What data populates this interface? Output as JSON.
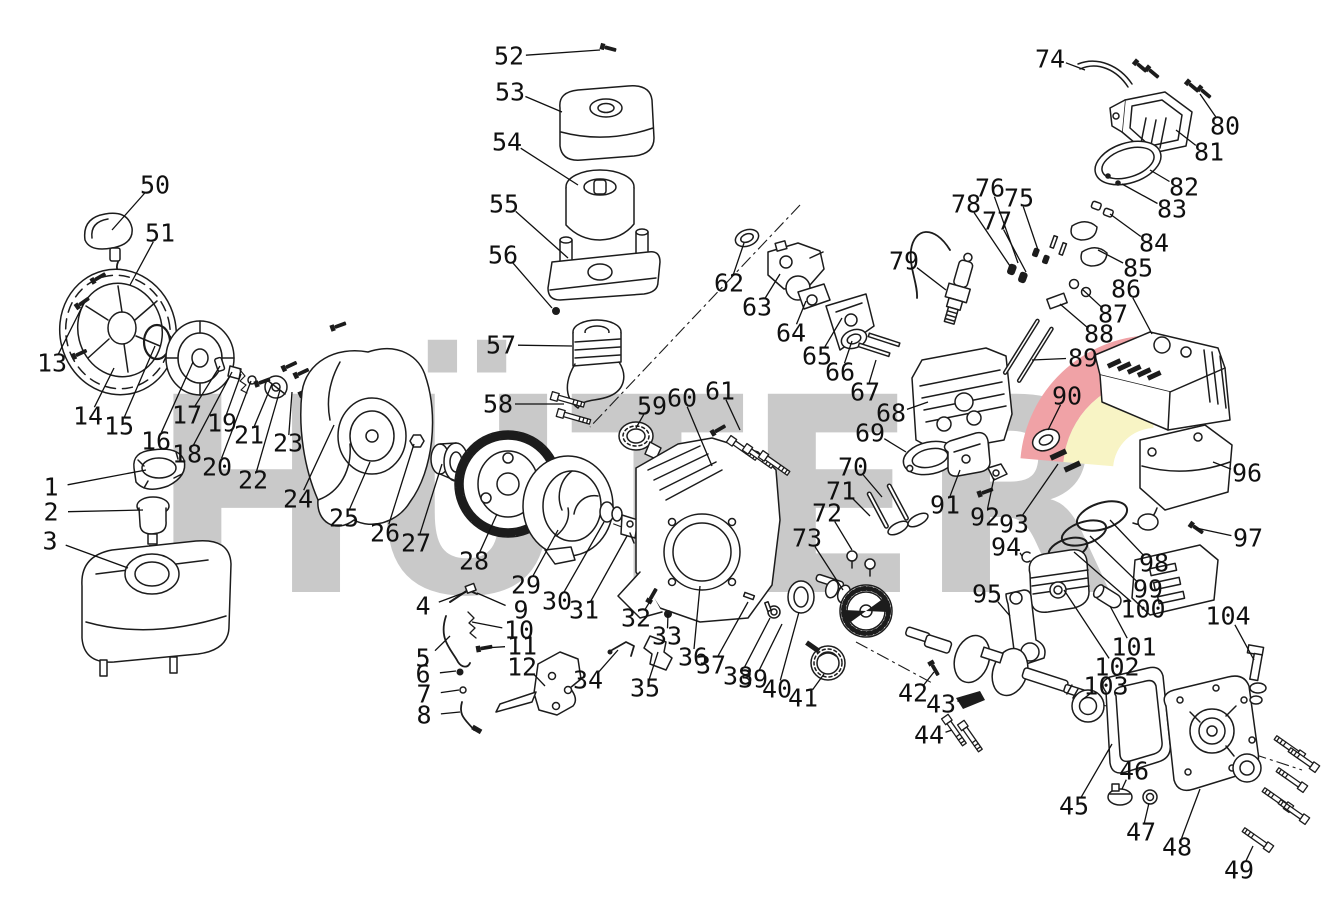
{
  "watermark": {
    "text": "HÜTER",
    "gray": "#c9c9c9",
    "red": "#f0a2a6",
    "yellow": "#f8f4c5"
  },
  "diagram": {
    "stroke_color": "#1c1c1c",
    "parts": [
      {
        "n": "1",
        "lx": 51,
        "ly": 487,
        "tx": 146,
        "ty": 470
      },
      {
        "n": "2",
        "lx": 51,
        "ly": 512,
        "tx": 143,
        "ty": 510
      },
      {
        "n": "3",
        "lx": 50,
        "ly": 541,
        "tx": 128,
        "ty": 568
      },
      {
        "n": "4",
        "lx": 423,
        "ly": 606,
        "tx": 466,
        "ty": 592
      },
      {
        "n": "5",
        "lx": 423,
        "ly": 658,
        "tx": 450,
        "ty": 636
      },
      {
        "n": "6",
        "lx": 423,
        "ly": 674,
        "tx": 456,
        "ty": 671
      },
      {
        "n": "7",
        "lx": 424,
        "ly": 694,
        "tx": 459,
        "ty": 690
      },
      {
        "n": "8",
        "lx": 424,
        "ly": 715,
        "tx": 460,
        "ty": 712
      },
      {
        "n": "9",
        "lx": 521,
        "ly": 610,
        "tx": 477,
        "ty": 593
      },
      {
        "n": "10",
        "lx": 519,
        "ly": 630,
        "tx": 472,
        "ty": 622
      },
      {
        "n": "11",
        "lx": 522,
        "ly": 646,
        "tx": 484,
        "ty": 648
      },
      {
        "n": "12",
        "lx": 522,
        "ly": 667,
        "tx": 545,
        "ty": 686
      },
      {
        "n": "13",
        "lx": 52,
        "ly": 363,
        "tx": 84,
        "ty": 303
      },
      {
        "n": "14",
        "lx": 88,
        "ly": 416,
        "tx": 114,
        "ty": 368
      },
      {
        "n": "15",
        "lx": 119,
        "ly": 426,
        "tx": 155,
        "ty": 346
      },
      {
        "n": "16",
        "lx": 156,
        "ly": 441,
        "tx": 193,
        "ty": 362
      },
      {
        "n": "17",
        "lx": 187,
        "ly": 415,
        "tx": 220,
        "ty": 366
      },
      {
        "n": "18",
        "lx": 187,
        "ly": 454,
        "tx": 232,
        "ty": 372
      },
      {
        "n": "19",
        "lx": 222,
        "ly": 423,
        "tx": 241,
        "ty": 374
      },
      {
        "n": "20",
        "lx": 217,
        "ly": 467,
        "tx": 251,
        "ty": 381
      },
      {
        "n": "21",
        "lx": 249,
        "ly": 435,
        "tx": 272,
        "ty": 384
      },
      {
        "n": "22",
        "lx": 253,
        "ly": 480,
        "tx": 280,
        "ty": 390
      },
      {
        "n": "23",
        "lx": 288,
        "ly": 443,
        "tx": 292,
        "ty": 392
      },
      {
        "n": "24",
        "lx": 298,
        "ly": 499,
        "tx": 334,
        "ty": 425
      },
      {
        "n": "25",
        "lx": 344,
        "ly": 518,
        "tx": 370,
        "ty": 462
      },
      {
        "n": "26",
        "lx": 385,
        "ly": 533,
        "tx": 414,
        "ty": 444
      },
      {
        "n": "27",
        "lx": 416,
        "ly": 543,
        "tx": 442,
        "ty": 464
      },
      {
        "n": "28",
        "lx": 474,
        "ly": 561,
        "tx": 497,
        "ty": 514
      },
      {
        "n": "29",
        "lx": 526,
        "ly": 585,
        "tx": 558,
        "ty": 530
      },
      {
        "n": "30",
        "lx": 557,
        "ly": 601,
        "tx": 604,
        "ty": 522
      },
      {
        "n": "31",
        "lx": 584,
        "ly": 610,
        "tx": 627,
        "ty": 536
      },
      {
        "n": "32",
        "lx": 636,
        "ly": 618,
        "tx": 652,
        "ty": 598
      },
      {
        "n": "33",
        "lx": 667,
        "ly": 636,
        "tx": 668,
        "ty": 614
      },
      {
        "n": "34",
        "lx": 588,
        "ly": 680,
        "tx": 618,
        "ty": 650
      },
      {
        "n": "35",
        "lx": 645,
        "ly": 688,
        "tx": 658,
        "ty": 652
      },
      {
        "n": "36",
        "lx": 693,
        "ly": 657,
        "tx": 700,
        "ty": 586
      },
      {
        "n": "37",
        "lx": 711,
        "ly": 665,
        "tx": 748,
        "ty": 602
      },
      {
        "n": "38",
        "lx": 738,
        "ly": 676,
        "tx": 770,
        "ty": 618
      },
      {
        "n": "39",
        "lx": 753,
        "ly": 679,
        "tx": 782,
        "ty": 624
      },
      {
        "n": "40",
        "lx": 777,
        "ly": 689,
        "tx": 799,
        "ty": 612
      },
      {
        "n": "41",
        "lx": 803,
        "ly": 698,
        "tx": 824,
        "ty": 674
      },
      {
        "n": "42",
        "lx": 913,
        "ly": 693,
        "tx": 934,
        "ty": 672
      },
      {
        "n": "43",
        "lx": 941,
        "ly": 704,
        "tx": 960,
        "ty": 700
      },
      {
        "n": "44",
        "lx": 929,
        "ly": 735,
        "tx": 952,
        "ty": 730
      },
      {
        "n": "45",
        "lx": 1074,
        "ly": 806,
        "tx": 1112,
        "ty": 744
      },
      {
        "n": "46",
        "lx": 1134,
        "ly": 771,
        "tx": 1122,
        "ty": 789
      },
      {
        "n": "47",
        "lx": 1141,
        "ly": 832,
        "tx": 1149,
        "ty": 803
      },
      {
        "n": "48",
        "lx": 1177,
        "ly": 847,
        "tx": 1200,
        "ty": 789
      },
      {
        "n": "49",
        "lx": 1239,
        "ly": 870,
        "tx": 1253,
        "ty": 846
      },
      {
        "n": "50",
        "lx": 155,
        "ly": 185,
        "tx": 112,
        "ty": 230
      },
      {
        "n": "51",
        "lx": 160,
        "ly": 233,
        "tx": 130,
        "ty": 285
      },
      {
        "n": "52",
        "lx": 509,
        "ly": 56,
        "tx": 600,
        "ty": 50
      },
      {
        "n": "53",
        "lx": 510,
        "ly": 92,
        "tx": 562,
        "ty": 112
      },
      {
        "n": "54",
        "lx": 507,
        "ly": 142,
        "tx": 578,
        "ty": 185
      },
      {
        "n": "55",
        "lx": 504,
        "ly": 204,
        "tx": 568,
        "ty": 258
      },
      {
        "n": "56",
        "lx": 503,
        "ly": 255,
        "tx": 552,
        "ty": 308
      },
      {
        "n": "57",
        "lx": 501,
        "ly": 345,
        "tx": 572,
        "ty": 346
      },
      {
        "n": "58",
        "lx": 498,
        "ly": 404,
        "tx": 564,
        "ty": 404
      },
      {
        "n": "59",
        "lx": 652,
        "ly": 406,
        "tx": 636,
        "ty": 428
      },
      {
        "n": "60",
        "lx": 682,
        "ly": 398,
        "tx": 712,
        "ty": 466
      },
      {
        "n": "61",
        "lx": 720,
        "ly": 391,
        "tx": 740,
        "ty": 430
      },
      {
        "n": "62",
        "lx": 729,
        "ly": 283,
        "tx": 744,
        "ty": 243
      },
      {
        "n": "63",
        "lx": 757,
        "ly": 307,
        "tx": 780,
        "ty": 274
      },
      {
        "n": "64",
        "lx": 791,
        "ly": 333,
        "tx": 806,
        "ty": 301
      },
      {
        "n": "65",
        "lx": 817,
        "ly": 356,
        "tx": 842,
        "ty": 318
      },
      {
        "n": "66",
        "lx": 840,
        "ly": 372,
        "tx": 852,
        "ty": 341
      },
      {
        "n": "67",
        "lx": 865,
        "ly": 392,
        "tx": 876,
        "ty": 360
      },
      {
        "n": "68",
        "lx": 891,
        "ly": 413,
        "tx": 928,
        "ty": 402
      },
      {
        "n": "69",
        "lx": 870,
        "ly": 433,
        "tx": 906,
        "ty": 452
      },
      {
        "n": "70",
        "lx": 853,
        "ly": 467,
        "tx": 882,
        "ty": 497
      },
      {
        "n": "71",
        "lx": 841,
        "ly": 491,
        "tx": 870,
        "ty": 516
      },
      {
        "n": "72",
        "lx": 827,
        "ly": 513,
        "tx": 852,
        "ty": 550
      },
      {
        "n": "73",
        "lx": 807,
        "ly": 538,
        "tx": 843,
        "ty": 590
      },
      {
        "n": "74",
        "lx": 1050,
        "ly": 59,
        "tx": 1085,
        "ty": 70
      },
      {
        "n": "75",
        "lx": 1019,
        "ly": 198,
        "tx": 1038,
        "ty": 250
      },
      {
        "n": "76",
        "lx": 990,
        "ly": 188,
        "tx": 1018,
        "ty": 263
      },
      {
        "n": "77",
        "lx": 997,
        "ly": 221,
        "tx": 1026,
        "ty": 272
      },
      {
        "n": "78",
        "lx": 966,
        "ly": 204,
        "tx": 1010,
        "ty": 266
      },
      {
        "n": "79",
        "lx": 904,
        "ly": 261,
        "tx": 946,
        "ty": 290
      },
      {
        "n": "80",
        "lx": 1225,
        "ly": 126,
        "tx": 1200,
        "ty": 94
      },
      {
        "n": "81",
        "lx": 1209,
        "ly": 152,
        "tx": 1176,
        "ty": 130
      },
      {
        "n": "82",
        "lx": 1184,
        "ly": 187,
        "tx": 1150,
        "ty": 170
      },
      {
        "n": "83",
        "lx": 1172,
        "ly": 209,
        "tx": 1122,
        "ty": 184
      },
      {
        "n": "84",
        "lx": 1154,
        "ly": 243,
        "tx": 1110,
        "ty": 214
      },
      {
        "n": "85",
        "lx": 1138,
        "ly": 268,
        "tx": 1098,
        "ty": 250
      },
      {
        "n": "86",
        "lx": 1126,
        "ly": 289,
        "tx": 1152,
        "ty": 334
      },
      {
        "n": "87",
        "lx": 1113,
        "ly": 314,
        "tx": 1082,
        "ty": 289
      },
      {
        "n": "88",
        "lx": 1099,
        "ly": 334,
        "tx": 1060,
        "ty": 304
      },
      {
        "n": "89",
        "lx": 1083,
        "ly": 358,
        "tx": 1032,
        "ty": 360
      },
      {
        "n": "90",
        "lx": 1067,
        "ly": 396,
        "tx": 1048,
        "ty": 430
      },
      {
        "n": "91",
        "lx": 945,
        "ly": 505,
        "tx": 960,
        "ty": 470
      },
      {
        "n": "92",
        "lx": 985,
        "ly": 517,
        "tx": 994,
        "ty": 478
      },
      {
        "n": "93",
        "lx": 1014,
        "ly": 524,
        "tx": 1058,
        "ty": 464
      },
      {
        "n": "94",
        "lx": 1006,
        "ly": 547,
        "tx": 1022,
        "ty": 556
      },
      {
        "n": "95",
        "lx": 987,
        "ly": 594,
        "tx": 1010,
        "ty": 616
      },
      {
        "n": "96",
        "lx": 1247,
        "ly": 473,
        "tx": 1213,
        "ty": 462
      },
      {
        "n": "97",
        "lx": 1248,
        "ly": 538,
        "tx": 1196,
        "ty": 528
      },
      {
        "n": "98",
        "lx": 1154,
        "ly": 563,
        "tx": 1110,
        "ty": 520
      },
      {
        "n": "99",
        "lx": 1148,
        "ly": 589,
        "tx": 1090,
        "ty": 536
      },
      {
        "n": "100",
        "lx": 1143,
        "ly": 609,
        "tx": 1074,
        "ty": 552
      },
      {
        "n": "101",
        "lx": 1134,
        "ly": 647,
        "tx": 1110,
        "ty": 606
      },
      {
        "n": "102",
        "lx": 1117,
        "ly": 667,
        "tx": 1064,
        "ty": 590
      },
      {
        "n": "103",
        "lx": 1106,
        "ly": 686,
        "tx": 1082,
        "ty": 700
      },
      {
        "n": "104",
        "lx": 1228,
        "ly": 616,
        "tx": 1254,
        "ty": 660
      }
    ]
  }
}
